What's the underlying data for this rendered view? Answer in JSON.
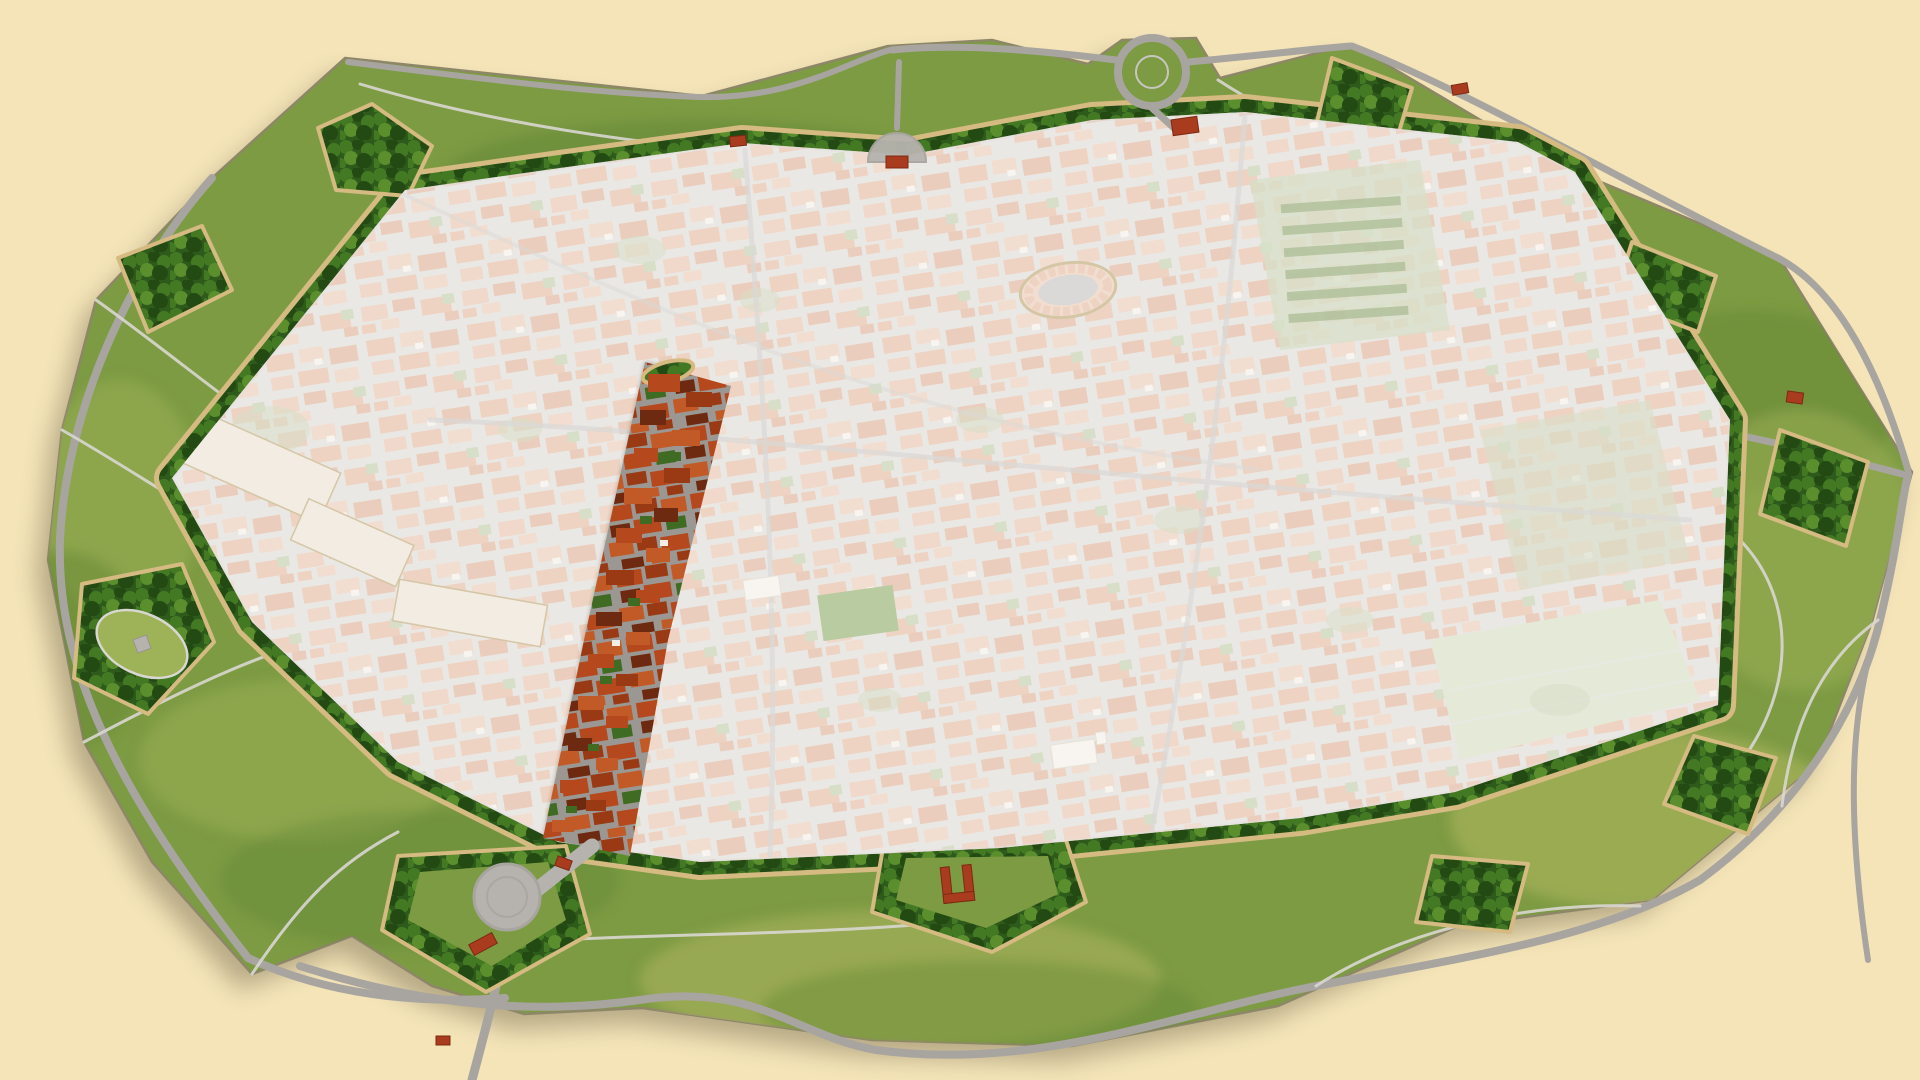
{
  "scene": {
    "title": "Aerial illustrated map of a star-shaped walled city",
    "style": "3D painted bird's-eye view, no text labels",
    "background": "plain cream",
    "landmarks": {
      "old_town": "dense faded terracotta-roof town inside the ramparts",
      "highlighted_district": "vivid red-roofed strip from the town centre down to the south-west gate; rest of town is whitened",
      "amphitheater_oval": "oval piazza ringed by buildings in the north-central town",
      "rampart_ring": "tree-lined green ramparts with tan retaining wall and pointed bastions",
      "south_gate_plaza": "round grey plaza on the south-west gate bastion",
      "north_gate_plaza": "semicircular grey plaza on the north wall",
      "north_roundabout": "circular road loop on the northern glacis",
      "red_u_building": "U-shaped brick structure on the southern bastion",
      "east_gardens": "large pale-green monastery gardens and fields in the eastern town"
    }
  },
  "colors": {
    "background": "#f4e4b8",
    "fortressShadow": "#6e6549",
    "grassBase": "#7d9b43",
    "grassLight": "#9eb257",
    "grassDark": "#5e8230",
    "grassYellow": "#adb55e",
    "treeDark": "#2e5a1c",
    "treeMid": "#447924",
    "treeLight": "#5b8f2d",
    "treeDeep": "#234a12",
    "wallTan": "#d5ba82",
    "wallTanDark": "#b2975e",
    "roadGray": "#a8a5a0",
    "roadLight": "#c9c6c0",
    "pathWhite": "#d9d7d1",
    "cityBase": "#d9d5cf",
    "streetGray": "#bcbab8",
    "roofFaded1": "#e0b092",
    "roofFaded2": "#e8c4aa",
    "roofFaded3": "#d9a585",
    "roofFaded4": "#e4bb9e",
    "whiteBldg": "#f2ede5",
    "gardenSage": "#b7c59b",
    "gardenRow": "#6e8b46",
    "fieldPale": "#cfd8b8",
    "piazzaGreen": "#7fa055",
    "bldgPale": "#e9dccb",
    "hazeWhite": "#ffffff",
    "vividBase": "#9b9792",
    "roofVivid1": "#b5481c",
    "roofVivid2": "#c25a28",
    "roofVivid3": "#9a3a14",
    "roofVividDark": "#6e2a10",
    "courtyardGreen": "#3f6b22",
    "brickRed": "#a93c1e",
    "plazaGray": "#b6b3ae"
  }
}
